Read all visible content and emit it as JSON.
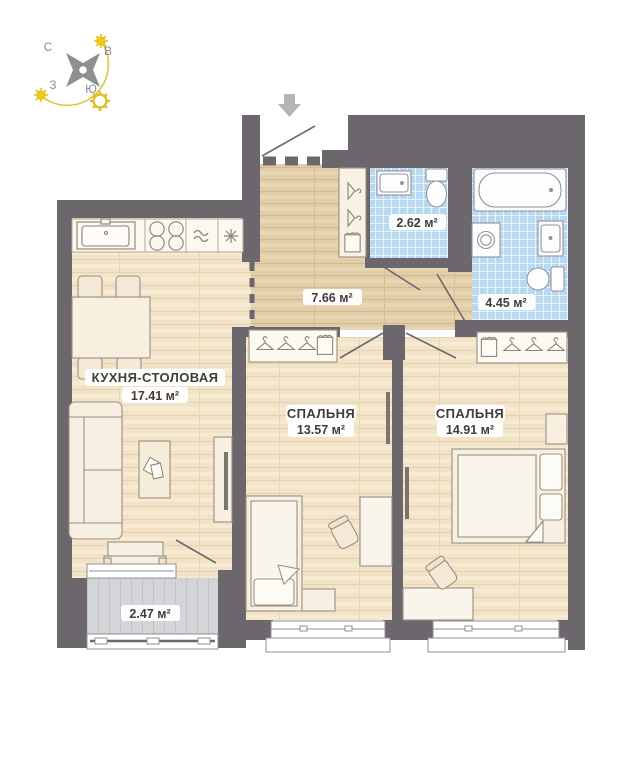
{
  "compass": {
    "north": "С",
    "east": "В",
    "west": "З",
    "south": "Ю"
  },
  "rooms": {
    "kitchen_dining": {
      "name": "КУХНЯ-СТОЛОВАЯ",
      "area": "17.41 м²"
    },
    "hallway": {
      "area": "7.66 м²"
    },
    "bathroom_small": {
      "area": "2.62 м²"
    },
    "bathroom_large": {
      "area": "4.45 м²"
    },
    "bedroom_1": {
      "name": "СПАЛЬНЯ",
      "area": "13.57 м²"
    },
    "bedroom_2": {
      "name": "СПАЛЬНЯ",
      "area": "14.91 м²"
    },
    "balcony": {
      "area": "2.47 м²"
    }
  },
  "colors": {
    "wall": "#6c676c",
    "tile_floor": "#b9d9f1",
    "wood_floor": "#f2e3c8",
    "hall_floor": "#e1cda8",
    "balcony_floor": "#d4d5d8",
    "sun_accent": "#e5c41c",
    "entry_arrow": "#b5b5b5"
  }
}
